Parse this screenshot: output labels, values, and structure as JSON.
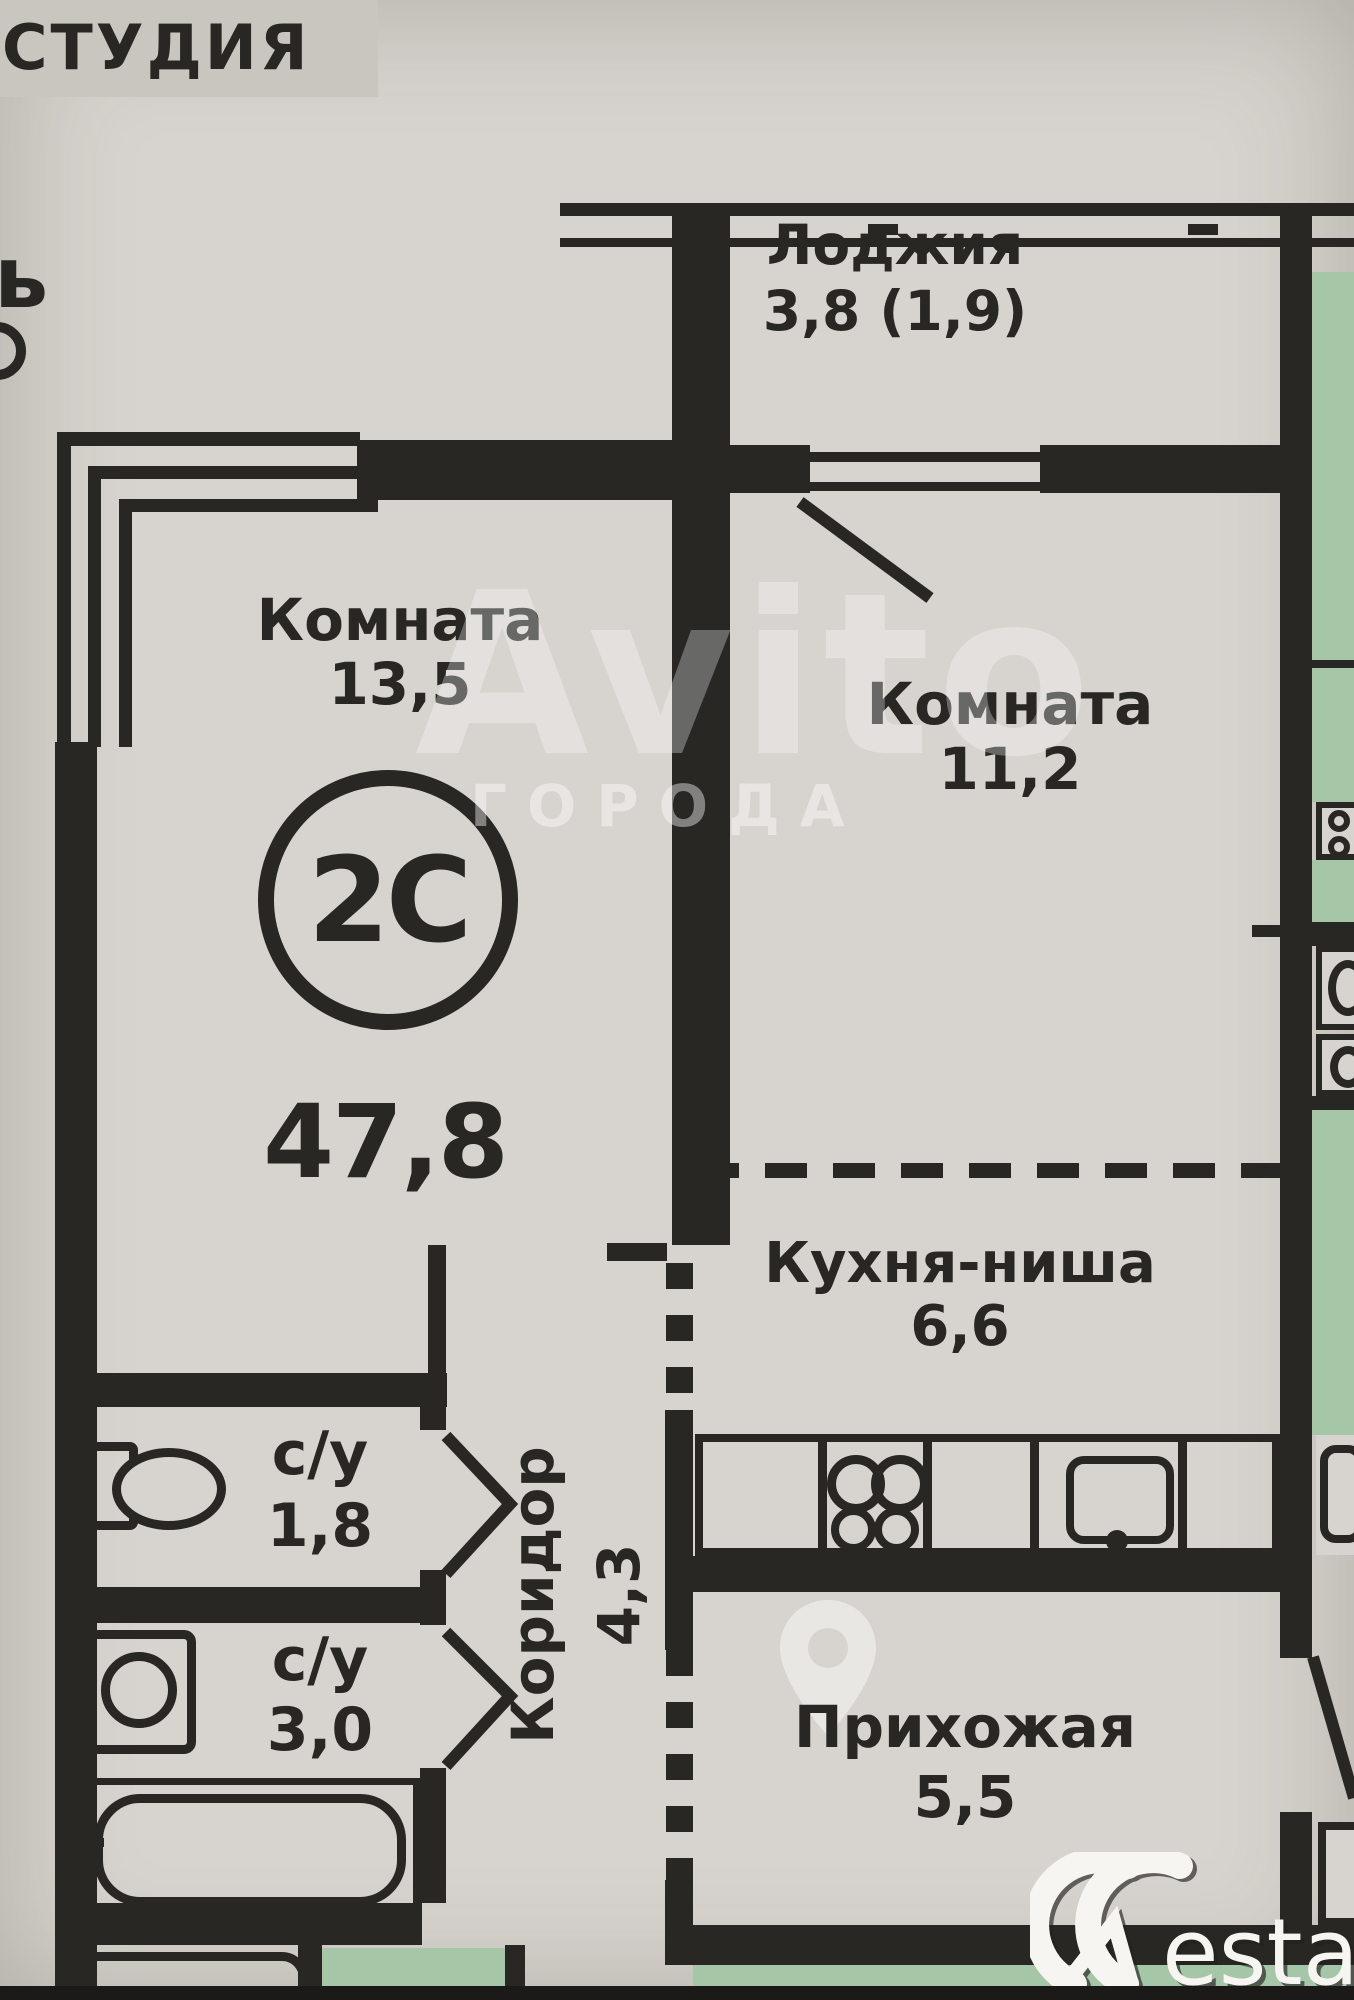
{
  "colors": {
    "paper": "#d7d3ce",
    "ink": "#282724",
    "green": "#a6c7a7",
    "band": "#c9c5bf"
  },
  "header": {
    "studio_label": "СТУДИЯ",
    "cut_text_left": "ь"
  },
  "plan": {
    "badge": "2С",
    "total_area": "47,8",
    "rooms": {
      "loggia": {
        "label": "Лоджия",
        "area": "3,8 (1,9)"
      },
      "room1": {
        "label": "Комната",
        "area": "13,5"
      },
      "room2": {
        "label": "Комната",
        "area": "11,2"
      },
      "kitchen": {
        "label": "Кухня-ниша",
        "area": "6,6"
      },
      "bath1": {
        "label": "с/у",
        "area": "1,8"
      },
      "bath2": {
        "label": "с/у",
        "area": "3,0"
      },
      "corridor": {
        "label": "Коридор",
        "area": "4,3"
      },
      "hall": {
        "label": "Прихожая",
        "area": "5,5"
      }
    }
  },
  "watermark": {
    "brand": "Avito",
    "sub": "ГОРОДА"
  },
  "footer": {
    "brand_rest": "estate"
  }
}
